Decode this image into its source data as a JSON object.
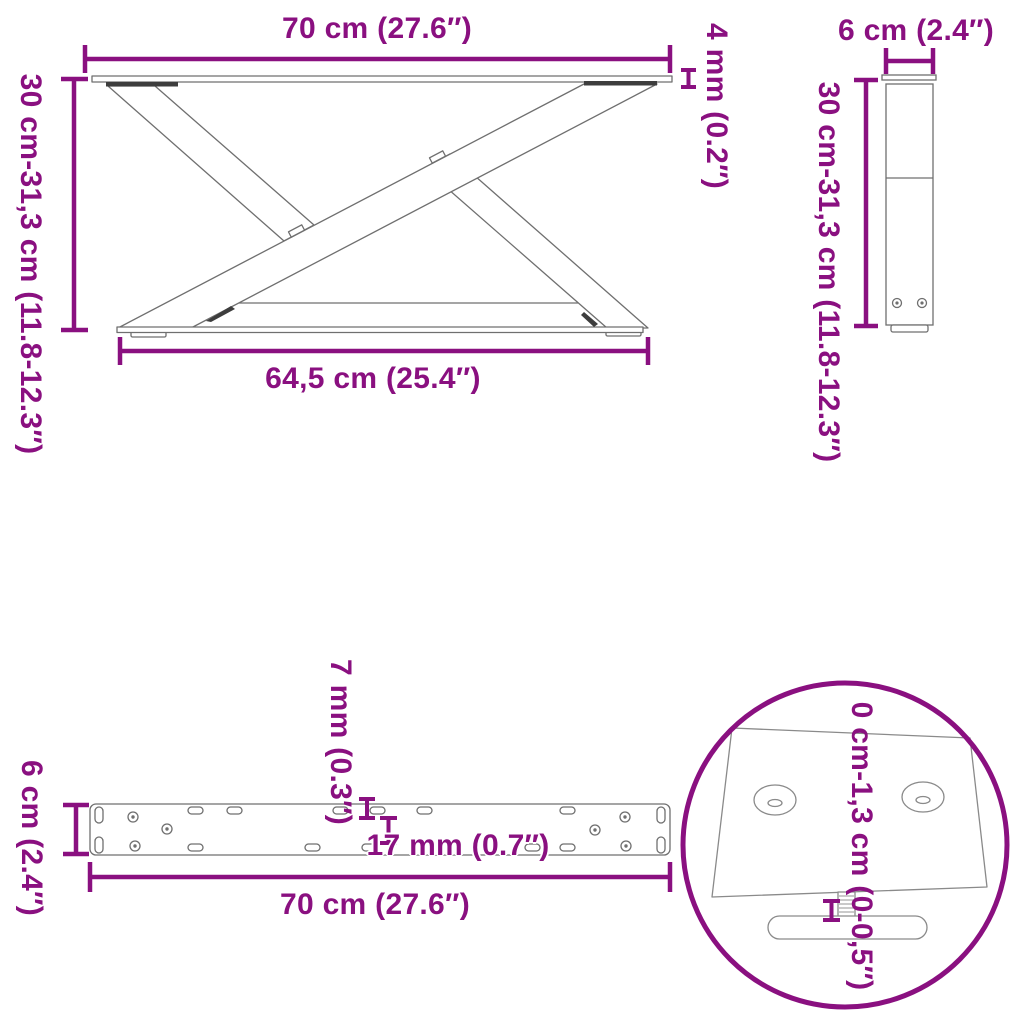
{
  "colors": {
    "accent": "#8A1080",
    "line_art": "#6f6f6f",
    "dark_fill": "#3d3d3d",
    "background": "#ffffff"
  },
  "front_view": {
    "top_width_label": "70 cm (27.6″)",
    "height_range_label": "30 cm-31,3 cm (11.8-12.3″)",
    "base_width_label": "64,5 cm (25.4″)",
    "plate_thickness_label": "4 mm (0.2″)"
  },
  "side_view": {
    "width_label": "6 cm (2.4″)",
    "height_range_label": "30 cm-31,3 cm (11.8-12.3″)"
  },
  "bottom_view": {
    "width_label": "70 cm (27.6″)",
    "depth_label": "6 cm (2.4″)",
    "plate_thickness_label": "7 mm (0.3″)",
    "hole_depth_label": "17 mm (0.7″)"
  },
  "foot_detail": {
    "adjustment_range_label": "0 cm-1,3 cm (0-0,5″)"
  }
}
